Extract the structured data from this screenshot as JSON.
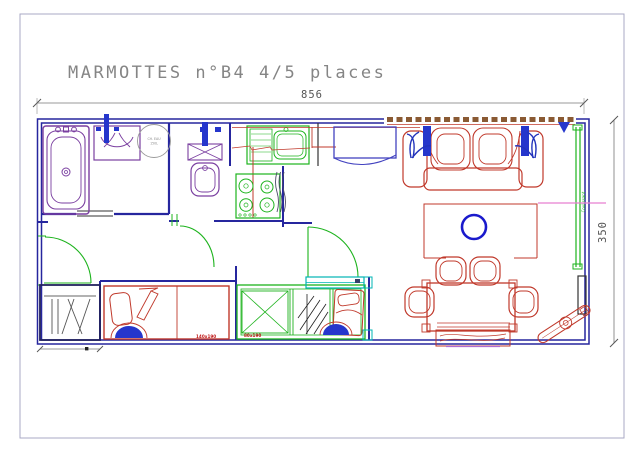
{
  "drawing": {
    "title": "MARMOTTES n°B4 4/5 places",
    "width_dim": "856",
    "height_dim": "350",
    "water_heater_label_1": "CH. EAU",
    "water_heater_label_2": "150L",
    "master_bed_label": "140x190",
    "bunk_bed_label": "80x190",
    "sliding_door_label": "Coulissant"
  },
  "palette": {
    "walls": "#26269e",
    "sanitary_purple": "#7a3fa0",
    "furniture_red": "#c0392b",
    "joinery_green": "#1db31d",
    "accent_blue": "#2536cc",
    "shelf_cyan": "#00b5b5",
    "window_brown": "#8a5a33",
    "axis_pink": "#e87fd0",
    "dimension_gray": "#777777",
    "title_gray": "#858585"
  }
}
